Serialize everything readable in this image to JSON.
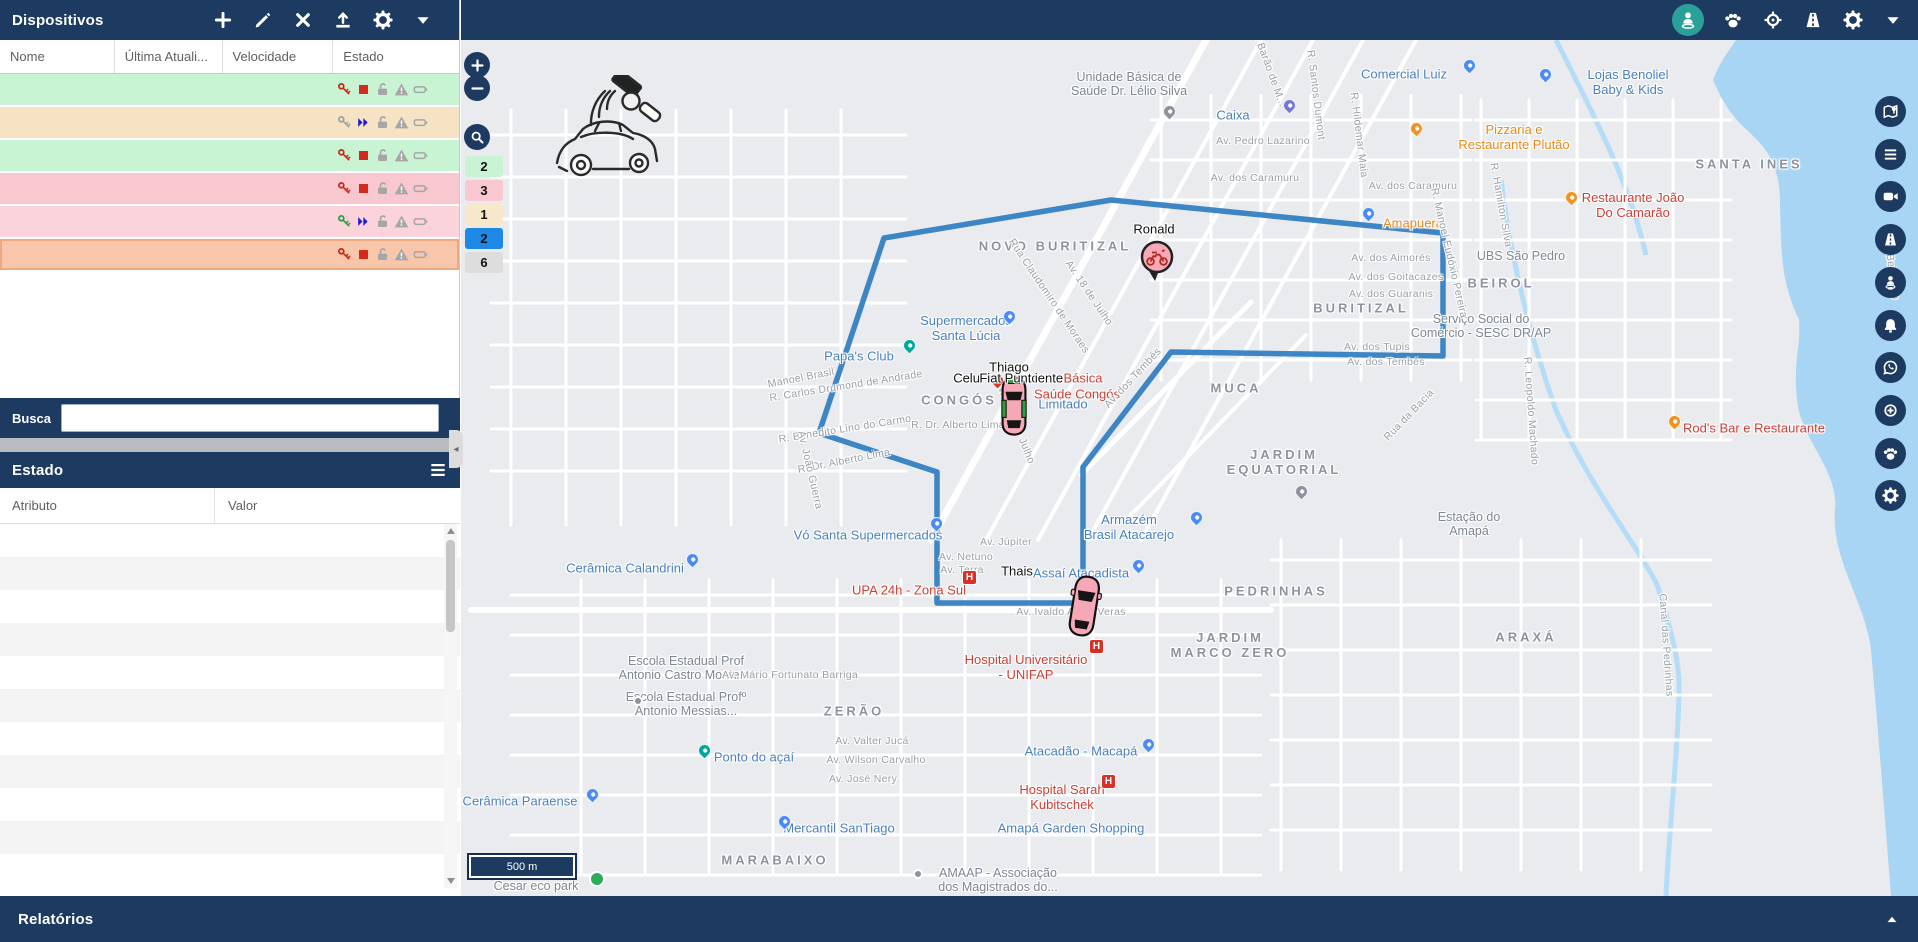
{
  "app": {
    "devices_title": "Dispositivos",
    "search_label": "Busca",
    "state_title": "Estado",
    "reports_title": "Relatórios",
    "accent_navy": "#1d3b60",
    "accent_teal": "#2aa198"
  },
  "devices": {
    "columns": [
      "Nome",
      "Última Atuali...",
      "Velocidade",
      "Estado"
    ],
    "toolbar_icons": [
      "plus-icon",
      "pencil-icon",
      "close-icon",
      "upload-icon",
      "gear-icon",
      "chevron-down-icon"
    ],
    "row_status_icons": [
      "key-icon",
      "motion-icon",
      "unlock-icon",
      "warning-icon",
      "battery-icon"
    ],
    "rows": [
      {
        "name": "Thiago",
        "updated": "3 minutos",
        "speed": "0.0 Km/h",
        "row_color": "#c9f4d4",
        "key": "red",
        "motion": "stop",
        "selected": false
      },
      {
        "name": "Celular Teste...",
        "updated": "5 dias",
        "speed": "18.2 Km/h",
        "row_color": "#f6e3c4",
        "key": "gray",
        "motion": "move",
        "selected": false
      },
      {
        "name": "VW Polo",
        "updated": "10 minutos",
        "speed": "0.0 Km/h",
        "row_color": "#c9f4d4",
        "key": "red",
        "motion": "stop",
        "selected": false
      },
      {
        "name": "Fiat Punto",
        "updated": "30 minutos",
        "speed": "0.2 Km/h",
        "row_color": "#f9c7cf",
        "key": "red",
        "motion": "stop",
        "selected": false
      },
      {
        "name": "Ronald",
        "updated": "18 minutos",
        "speed": "49.3 Km/h",
        "row_color": "#fbd3da",
        "key": "green",
        "motion": "move",
        "selected": false
      },
      {
        "name": "Thais",
        "updated": "33 minutos",
        "speed": "0.0 Km/h",
        "row_color": "#f8c7ab",
        "key": "red",
        "motion": "stop",
        "selected": true
      }
    ],
    "icon_colors": {
      "key_red": "#c62817",
      "key_gray": "#a0a0a0",
      "key_green": "#2e9e43",
      "stop_square": "#d42a1e",
      "moving_chevrons": "#1f1fd1",
      "inactive_gray": "#a6a6a6"
    }
  },
  "state": {
    "columns": [
      "Atributo",
      "Valor"
    ],
    "rows": [
      {
        "attr": "Tempo",
        "value": "15:02:50 11-08-2021"
      },
      {
        "attr": "Latitude",
        "value": "0.002350°"
      },
      {
        "attr": "Longitude",
        "value": "-51.083297°"
      },
      {
        "attr": "Válido",
        "value": "Sim"
      },
      {
        "attr": "Precisão",
        "value": "0.00 Km"
      },
      {
        "attr": "Altitude",
        "value": "0"
      },
      {
        "attr": "Velocidade",
        "value": "0.0 Km/h"
      },
      {
        "attr": "Direção",
        "value": "Facing North"
      },
      {
        "attr": "Endereço",
        "value": "Mostrar Endereço",
        "link": true
      },
      {
        "attr": "Protocolo",
        "value": "suntech"
      },
      {
        "attr": "Tipo",
        "value": "STT"
      }
    ]
  },
  "map": {
    "scale_label": "500 m",
    "topbar_icons": [
      {
        "icon": "person-icon",
        "active": true
      },
      {
        "icon": "paw-icon",
        "active": false
      },
      {
        "icon": "crosshair-icon",
        "active": false
      },
      {
        "icon": "road-icon",
        "active": false
      },
      {
        "icon": "gear-icon",
        "active": false
      },
      {
        "icon": "chevron-down-icon",
        "active": false
      }
    ],
    "side_button_icons": [
      "map-pin-icon",
      "list-icon",
      "camera-icon",
      "road-icon",
      "person-pin-icon",
      "bell-icon",
      "whatsapp-icon",
      "crosshair-plus-icon",
      "paw-icon",
      "gear-icon"
    ],
    "zoom_controls": [
      "zoom-in",
      "zoom-out",
      "search-area"
    ],
    "cluster_chips": [
      {
        "label": "2",
        "color": "#c9f4d4"
      },
      {
        "label": "3",
        "color": "#f9c7cf"
      },
      {
        "label": "1",
        "color": "#f6e8c8"
      },
      {
        "label": "2",
        "color": "#1e88e5"
      },
      {
        "label": "6",
        "color": "#dddddd"
      }
    ],
    "route": {
      "color": "#2e7cc0",
      "points": "358,393 423,198 650,160 982,193 982,316 710,312 622,427 622,563 476,563 476,432 358,393"
    },
    "vehicles": [
      {
        "name": "Ronald",
        "type": "motorcycle",
        "x": 695,
        "y": 218
      },
      {
        "name": "cluster-car",
        "type": "car-green-trim",
        "x": 553,
        "y": 365
      },
      {
        "name": "Thais",
        "type": "car",
        "x": 623,
        "y": 565
      }
    ],
    "labels": [
      {
        "t": "NOVO BURITIZAL",
        "x": 594,
        "y": 206,
        "c": "city"
      },
      {
        "t": "BURITIZAL",
        "x": 900,
        "y": 268,
        "c": "city"
      },
      {
        "t": "BEIROL",
        "x": 1040,
        "y": 243,
        "c": "city"
      },
      {
        "t": "MUCA",
        "x": 775,
        "y": 348,
        "c": "city"
      },
      {
        "t": "JARDIM\nEQUATORIAL",
        "x": 823,
        "y": 422,
        "c": "city"
      },
      {
        "t": "CONGÓS",
        "x": 498,
        "y": 360,
        "c": "city"
      },
      {
        "t": "SANTA INES",
        "x": 1288,
        "y": 124,
        "c": "city"
      },
      {
        "t": "PEDRINHAS",
        "x": 815,
        "y": 551,
        "c": "city"
      },
      {
        "t": "JARDIM\nMARCO ZERO",
        "x": 769,
        "y": 605,
        "c": "city"
      },
      {
        "t": "ARAXÁ",
        "x": 1065,
        "y": 597,
        "c": "city"
      },
      {
        "t": "ZERÃO",
        "x": 393,
        "y": 671,
        "c": "city"
      },
      {
        "t": "MARABAIXO",
        "x": 314,
        "y": 820,
        "c": "city"
      },
      {
        "t": "Comercial Luiz",
        "x": 943,
        "y": 34,
        "c": "poi-blue"
      },
      {
        "t": "Lojas Benoliel\nBaby & Kids",
        "x": 1167,
        "y": 42,
        "c": "poi-blue"
      },
      {
        "t": "Caixa",
        "x": 772,
        "y": 75,
        "c": "poi-blue"
      },
      {
        "t": "Supermercados\nSanta Lúcia",
        "x": 505,
        "y": 288,
        "c": "poi-blue"
      },
      {
        "t": "Papa's Club",
        "x": 398,
        "y": 316,
        "c": "poi-blue"
      },
      {
        "t": "Vó Santa Supermercados",
        "x": 407,
        "y": 495,
        "c": "poi-blue"
      },
      {
        "t": "Armazém\nBrasil Atacarejo",
        "x": 668,
        "y": 487,
        "c": "poi-blue"
      },
      {
        "t": "Assaí Atacadista",
        "x": 620,
        "y": 533,
        "c": "poi-blue"
      },
      {
        "t": "Atacadão - Macapá",
        "x": 620,
        "y": 711,
        "c": "poi-blue"
      },
      {
        "t": "Amapá Garden Shopping",
        "x": 610,
        "y": 788,
        "c": "poi-blue"
      },
      {
        "t": "Mercantil SanTiago",
        "x": 378,
        "y": 788,
        "c": "poi-blue"
      },
      {
        "t": "Cerâmica Paraense",
        "x": 59,
        "y": 761,
        "c": "poi-blue"
      },
      {
        "t": "Cerâmica Calandrini",
        "x": 164,
        "y": 528,
        "c": "poi-blue"
      },
      {
        "t": "Ponto do açaí",
        "x": 293,
        "y": 717,
        "c": "poi-blue"
      },
      {
        "t": "Limitado",
        "x": 602,
        "y": 364,
        "c": "poi-blue"
      },
      {
        "t": "UPA 24h - Zona Sul",
        "x": 448,
        "y": 550,
        "c": "poi-red"
      },
      {
        "t": "Hospital Universitário\n- UNIFAP",
        "x": 565,
        "y": 627,
        "c": "poi-red"
      },
      {
        "t": "Hospital Sarah\nKubitschek",
        "x": 601,
        "y": 757,
        "c": "poi-red"
      },
      {
        "t": "Saúde Congós",
        "x": 616,
        "y": 354,
        "c": "poi-red"
      },
      {
        "t": "Básica",
        "x": 622,
        "y": 338,
        "c": "poi-red"
      },
      {
        "t": "Restaurante João\nDo Camarão",
        "x": 1172,
        "y": 165,
        "c": "poi-red"
      },
      {
        "t": "Rod's Bar e Restaurante",
        "x": 1293,
        "y": 388,
        "c": "poi-red"
      },
      {
        "t": "Pizzaria e\nRestaurante Plutão",
        "x": 1053,
        "y": 97,
        "c": "poi-orange"
      },
      {
        "t": "Amapuera",
        "x": 952,
        "y": 183,
        "c": "poi-orange"
      },
      {
        "t": "Unidade Básica de\nSaúde Dr. Lélio Silva",
        "x": 668,
        "y": 44,
        "c": "poi-gray"
      },
      {
        "t": "UBS São Pedro",
        "x": 1060,
        "y": 216,
        "c": "poi-gray"
      },
      {
        "t": "Serviço Social do\nComércio - SESC DR/AP",
        "x": 1020,
        "y": 286,
        "c": "poi-gray"
      },
      {
        "t": "Estação do\nAmapá",
        "x": 1008,
        "y": 484,
        "c": "poi-gray"
      },
      {
        "t": "Escola Estadual Prof\nAntonio Castro Monteiro",
        "x": 225,
        "y": 628,
        "c": "poi-gray"
      },
      {
        "t": "Escola Estadual Profº\nAntonio Messias...",
        "x": 225,
        "y": 664,
        "c": "poi-gray"
      },
      {
        "t": "AMAAP - Associação\ndos Magistrados do...",
        "x": 537,
        "y": 840,
        "c": "poi-gray"
      },
      {
        "t": "Cesar eco park",
        "x": 75,
        "y": 846,
        "c": "poi-gray"
      },
      {
        "t": "Av. Pedro Lazarino",
        "x": 802,
        "y": 101,
        "c": "street"
      },
      {
        "t": "Av. dos Caramuru",
        "x": 794,
        "y": 138,
        "c": "street"
      },
      {
        "t": "Av. dos Caramuru",
        "x": 952,
        "y": 146,
        "c": "street"
      },
      {
        "t": "Av. dos Aimorés",
        "x": 930,
        "y": 218,
        "c": "street"
      },
      {
        "t": "Av. dos Goitacazes",
        "x": 935,
        "y": 237,
        "c": "street"
      },
      {
        "t": "Av. dos Guaranis",
        "x": 930,
        "y": 254,
        "c": "street"
      },
      {
        "t": "Av. dos Tupis",
        "x": 916,
        "y": 307,
        "c": "street"
      },
      {
        "t": "Av. dos Tembés",
        "x": 925,
        "y": 322,
        "c": "street"
      },
      {
        "t": "Av. Júpiter",
        "x": 545,
        "y": 502,
        "c": "street"
      },
      {
        "t": "Av. Netuno",
        "x": 505,
        "y": 517,
        "c": "street"
      },
      {
        "t": "Av. Terra",
        "x": 501,
        "y": 530,
        "c": "street"
      },
      {
        "t": "R. Dr. Alberto Lima",
        "x": 497,
        "y": 385,
        "c": "street"
      },
      {
        "t": "R. Benedito Lino do Carmo",
        "x": 384,
        "y": 389,
        "c": "street",
        "rot": -9
      },
      {
        "t": "R. Carlos Drumond de Andrade",
        "x": 385,
        "y": 346,
        "c": "street",
        "rot": -9
      },
      {
        "t": "R. Dr. Alberto Lima",
        "x": 383,
        "y": 421,
        "c": "street",
        "rot": -11
      },
      {
        "t": "Av. João Guerra",
        "x": 349,
        "y": 430,
        "c": "street",
        "rot": 77
      },
      {
        "t": "Manoel Brasil",
        "x": 340,
        "y": 338,
        "c": "street",
        "rot": -11
      },
      {
        "t": "Av. Valter Jucá",
        "x": 411,
        "y": 701,
        "c": "street"
      },
      {
        "t": "Av. Wilson Carvalho",
        "x": 415,
        "y": 720,
        "c": "street"
      },
      {
        "t": "Av. José Nery",
        "x": 402,
        "y": 739,
        "c": "street"
      },
      {
        "t": "Av. Mário Fortunato Barriga",
        "x": 329,
        "y": 635,
        "c": "street"
      },
      {
        "t": "Rua Claudomiro de Moraes",
        "x": 588,
        "y": 256,
        "c": "street",
        "rot": 56
      },
      {
        "t": "Av. 18 de Julho",
        "x": 628,
        "y": 253,
        "c": "street",
        "rot": 56
      },
      {
        "t": "Av. Vinte de Julho",
        "x": 554,
        "y": 382,
        "c": "street",
        "rot": 68
      },
      {
        "t": "Av. dos Tembés",
        "x": 672,
        "y": 338,
        "c": "street",
        "rot": -47
      },
      {
        "t": "R. Santos Dumont",
        "x": 855,
        "y": 55,
        "c": "street",
        "rot": 83
      },
      {
        "t": "R. Hildemar Maia",
        "x": 898,
        "y": 95,
        "c": "street",
        "rot": 83
      },
      {
        "t": "R. Barão de M...",
        "x": 808,
        "y": 28,
        "c": "street",
        "rot": 70
      },
      {
        "t": "R. Manoel Eudóxio Pereira",
        "x": 988,
        "y": 213,
        "c": "street",
        "rot": 77
      },
      {
        "t": "R. Hamilton Silva",
        "x": 1040,
        "y": 165,
        "c": "street",
        "rot": 80
      },
      {
        "t": "Rua da Bacia",
        "x": 948,
        "y": 375,
        "c": "street",
        "rot": -46
      },
      {
        "t": "R. Leopoldo Machado",
        "x": 1070,
        "y": 371,
        "c": "street",
        "rot": 86
      },
      {
        "t": "Canal das Pedrinhas",
        "x": 1205,
        "y": 605,
        "c": "street",
        "rot": 86
      },
      {
        "t": "Rua Beira Rio",
        "x": 1430,
        "y": 225,
        "c": "street",
        "rot": 83
      },
      {
        "t": "Av. Ivaldo Alves Veras",
        "x": 610,
        "y": 572,
        "c": "street"
      },
      {
        "t": "Ronald",
        "x": 693,
        "y": 189,
        "c": "veh"
      },
      {
        "t": "Thiago",
        "x": 548,
        "y": 327,
        "c": "veh"
      },
      {
        "t": "Celul",
        "x": 507,
        "y": 338,
        "c": "veh"
      },
      {
        "t": "Fiat Punto",
        "x": 548,
        "y": 338,
        "c": "veh"
      },
      {
        "t": "iente",
        "x": 588,
        "y": 338,
        "c": "veh"
      },
      {
        "t": "Thais",
        "x": 556,
        "y": 531,
        "c": "veh"
      }
    ],
    "pins": [
      {
        "k": "pin-blue",
        "x": 1008,
        "y": 32
      },
      {
        "k": "pin-blue",
        "x": 1084,
        "y": 41
      },
      {
        "k": "pin-purple",
        "x": 828,
        "y": 72
      },
      {
        "k": "pin-gray",
        "x": 708,
        "y": 78
      },
      {
        "k": "pin-orange",
        "x": 955,
        "y": 95
      },
      {
        "k": "pin-blue",
        "x": 907,
        "y": 180
      },
      {
        "k": "pin-orange",
        "x": 1110,
        "y": 164
      },
      {
        "k": "pin-teal",
        "x": 448,
        "y": 312
      },
      {
        "k": "pin-blue",
        "x": 548,
        "y": 283
      },
      {
        "k": "pin-red",
        "x": 536,
        "y": 347
      },
      {
        "k": "pin-blue",
        "x": 475,
        "y": 490
      },
      {
        "k": "pin-blue",
        "x": 735,
        "y": 484
      },
      {
        "k": "pin-blue",
        "x": 677,
        "y": 532
      },
      {
        "k": "hosp",
        "x": 508,
        "y": 545
      },
      {
        "k": "hosp",
        "x": 635,
        "y": 614
      },
      {
        "k": "hosp",
        "x": 647,
        "y": 749
      },
      {
        "k": "pin-teal",
        "x": 243,
        "y": 717
      },
      {
        "k": "pin-blue",
        "x": 231,
        "y": 526
      },
      {
        "k": "pin-blue",
        "x": 131,
        "y": 761
      },
      {
        "k": "pin-blue",
        "x": 323,
        "y": 788
      },
      {
        "k": "pin-blue",
        "x": 687,
        "y": 711
      },
      {
        "k": "dot-green",
        "x": 136,
        "y": 839
      },
      {
        "k": "dot-gray",
        "x": 457,
        "y": 834
      },
      {
        "k": "pin-orange",
        "x": 1213,
        "y": 388
      },
      {
        "k": "pin-gray",
        "x": 840,
        "y": 458
      },
      {
        "k": "dot-gray",
        "x": 177,
        "y": 661
      }
    ]
  }
}
